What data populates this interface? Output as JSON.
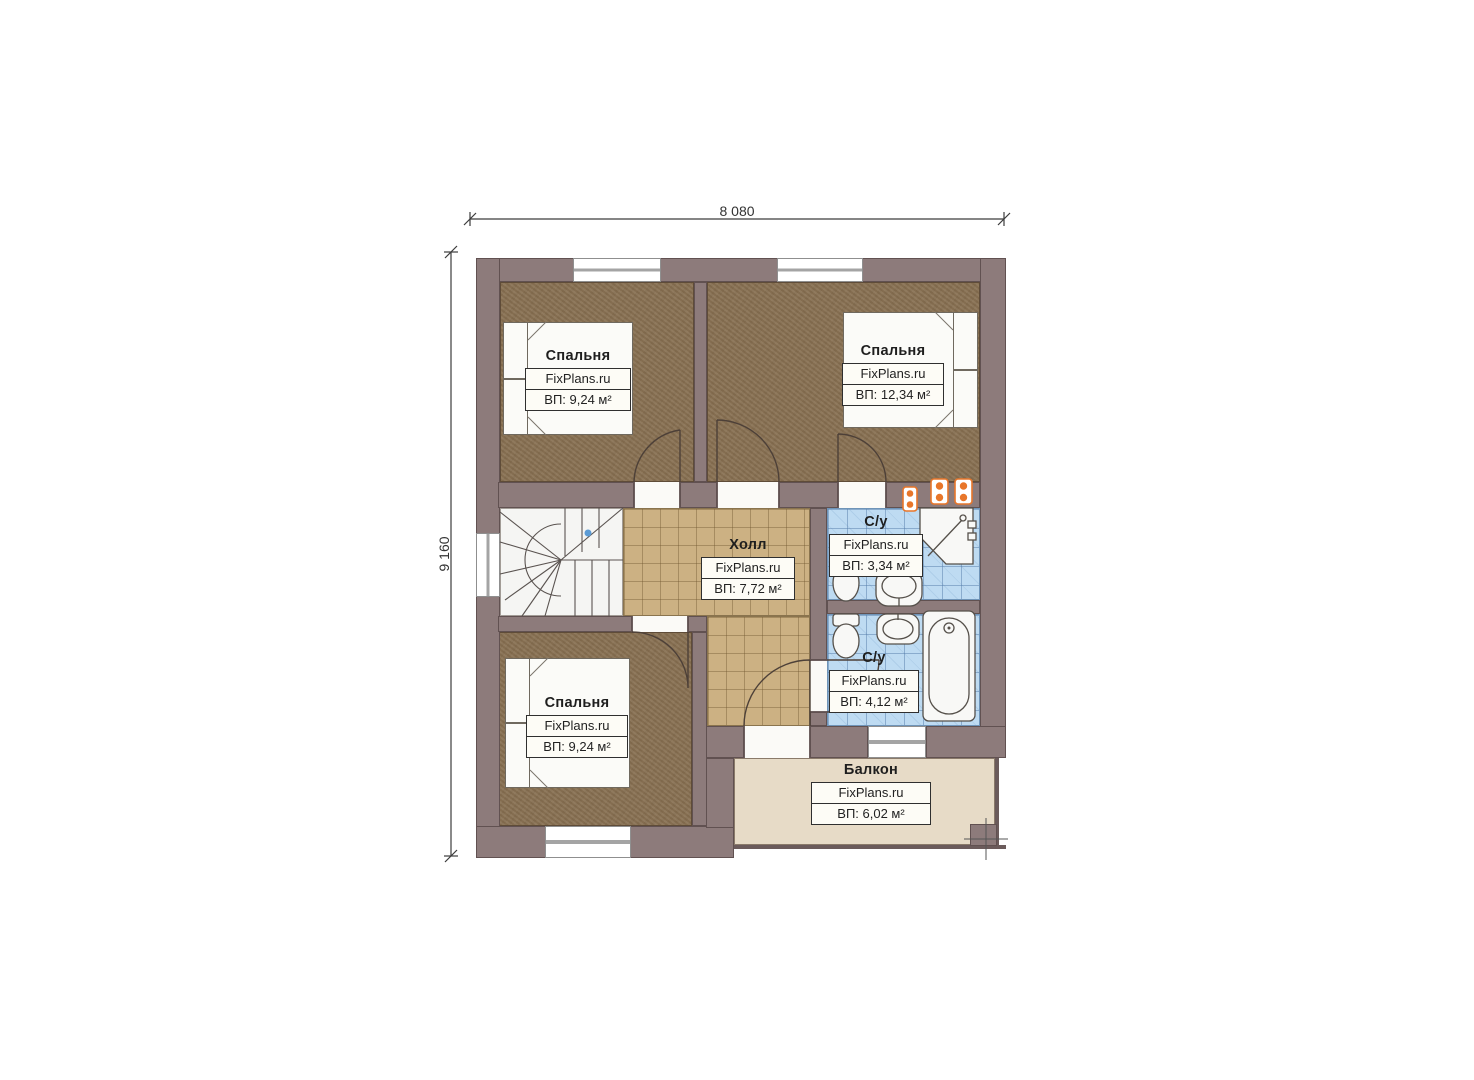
{
  "watermark": "FixPlans.ru",
  "dimensions": {
    "top": "8 080",
    "left": "9 160"
  },
  "rooms": [
    {
      "id": "bedroom-top-left",
      "name": "Спальня",
      "area": "ВП: 9,24 м²"
    },
    {
      "id": "bedroom-top-right",
      "name": "Спальня",
      "area": "ВП: 12,34 м²"
    },
    {
      "id": "bedroom-bottom-left",
      "name": "Спальня",
      "area": "ВП: 9,24 м²"
    },
    {
      "id": "hall",
      "name": "Холл",
      "area": "ВП: 7,72 м²"
    },
    {
      "id": "bathroom-top",
      "name": "С/у",
      "area": "ВП: 3,34 м²"
    },
    {
      "id": "bathroom-bottom",
      "name": "С/у",
      "area": "ВП: 4,12 м²"
    },
    {
      "id": "balcony",
      "name": "Балкон",
      "area": "ВП: 6,02 м²"
    }
  ],
  "colors": {
    "wall": "#8d7b7b",
    "carpet": "#8a7355",
    "hall_tile": "#ccb183",
    "bath_tile": "#bedbf2",
    "balcony_floor": "#e7dbc7",
    "vent_orange": "#e8762a"
  }
}
